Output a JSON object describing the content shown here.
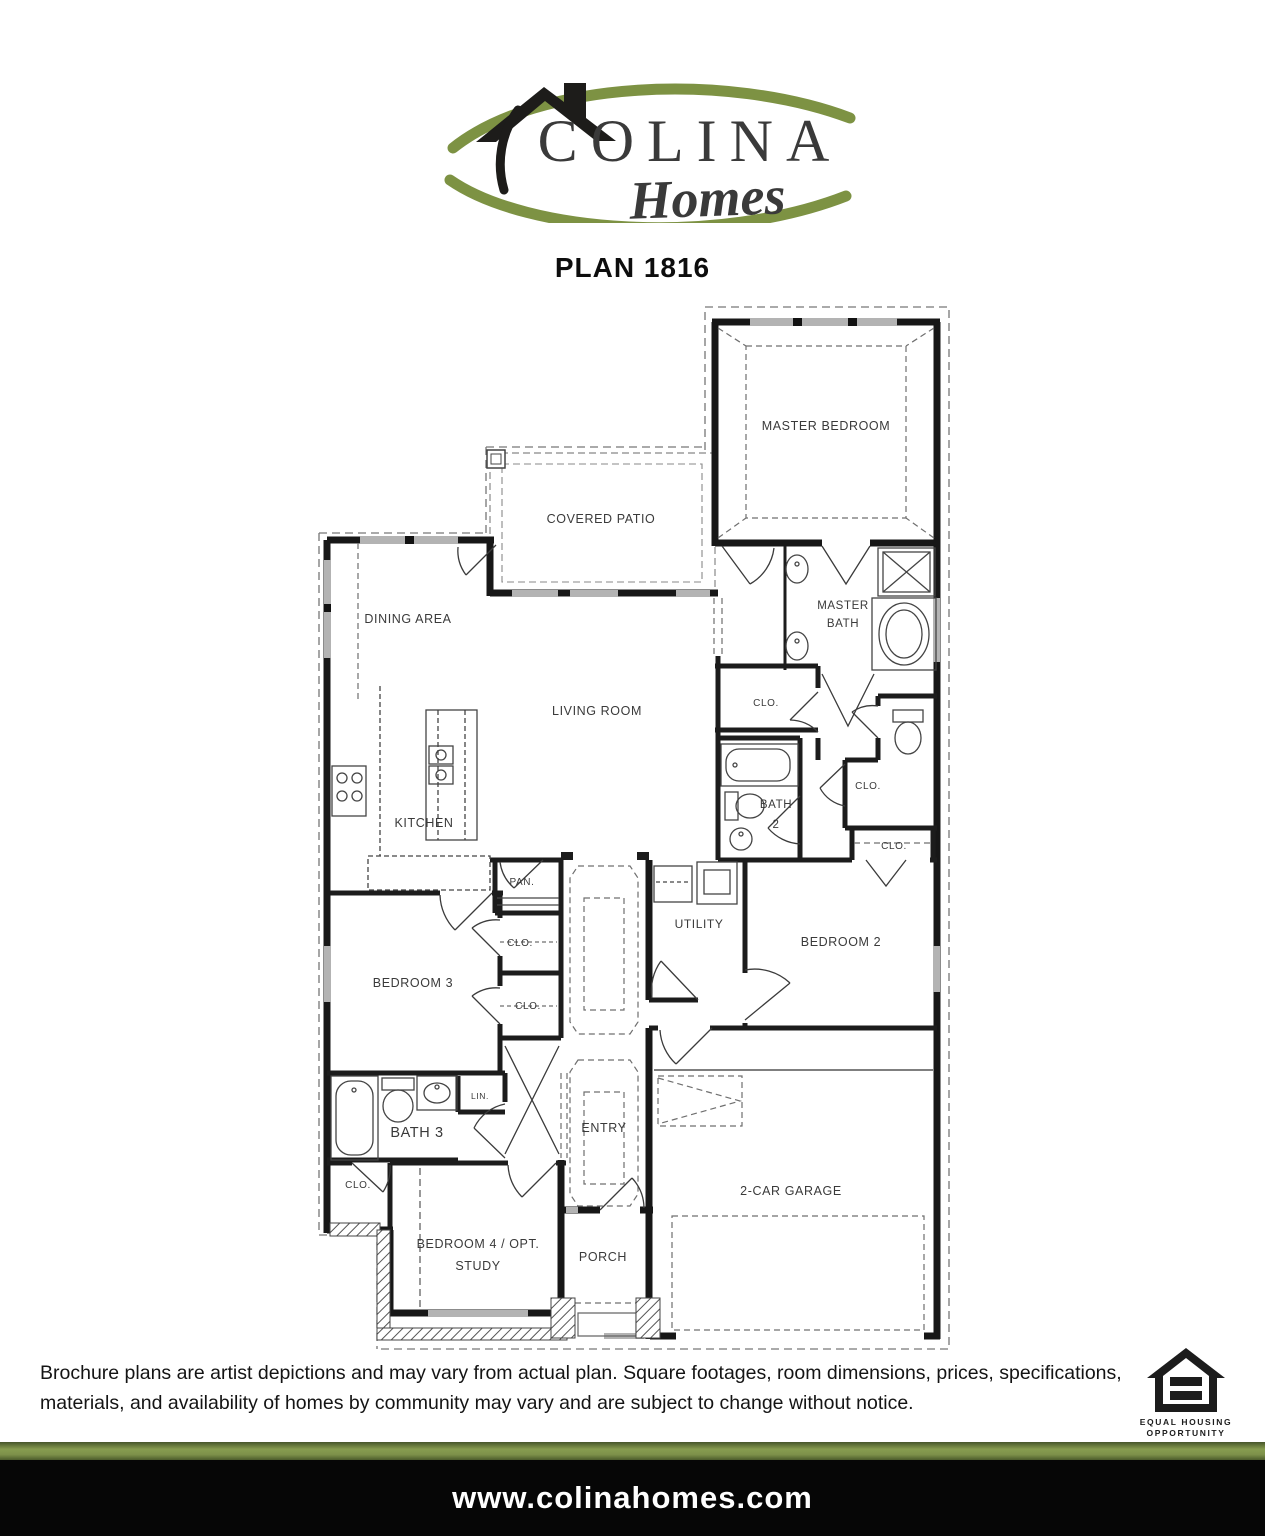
{
  "brand": {
    "name": "COLINA",
    "tagline": "Homes",
    "green": "#7d9243",
    "dark": "#34322b"
  },
  "plan": {
    "title": "PLAN 1816",
    "labels": {
      "master_bedroom": "MASTER BEDROOM",
      "covered_patio": "COVERED PATIO",
      "dining_area": "DINING AREA",
      "living_room": "LIVING ROOM",
      "kitchen": "KITCHEN",
      "pantry": "PAN.",
      "master_bath_1": "MASTER",
      "master_bath_2": "BATH",
      "bath2_1": "BATH",
      "bath2_2": "2",
      "clo": "CLO.",
      "lin": "LIN.",
      "utility": "UTILITY",
      "bedroom2": "BEDROOM 2",
      "bedroom3": "BEDROOM 3",
      "bath3": "BATH 3",
      "entry": "ENTRY",
      "bedroom4_1": "BEDROOM 4 / OPT.",
      "bedroom4_2": "STUDY",
      "porch": "PORCH",
      "garage": "2-CAR GARAGE"
    }
  },
  "footer": {
    "disclaimer": "Brochure plans are artist depictions and may vary from actual plan. Square footages, room dimensions, prices, specifications, materials, and availability of homes by community may vary and are subject to change without notice.",
    "equal_housing_1": "EQUAL HOUSING",
    "equal_housing_2": "OPPORTUNITY",
    "website": "www.colinahomes.com"
  }
}
